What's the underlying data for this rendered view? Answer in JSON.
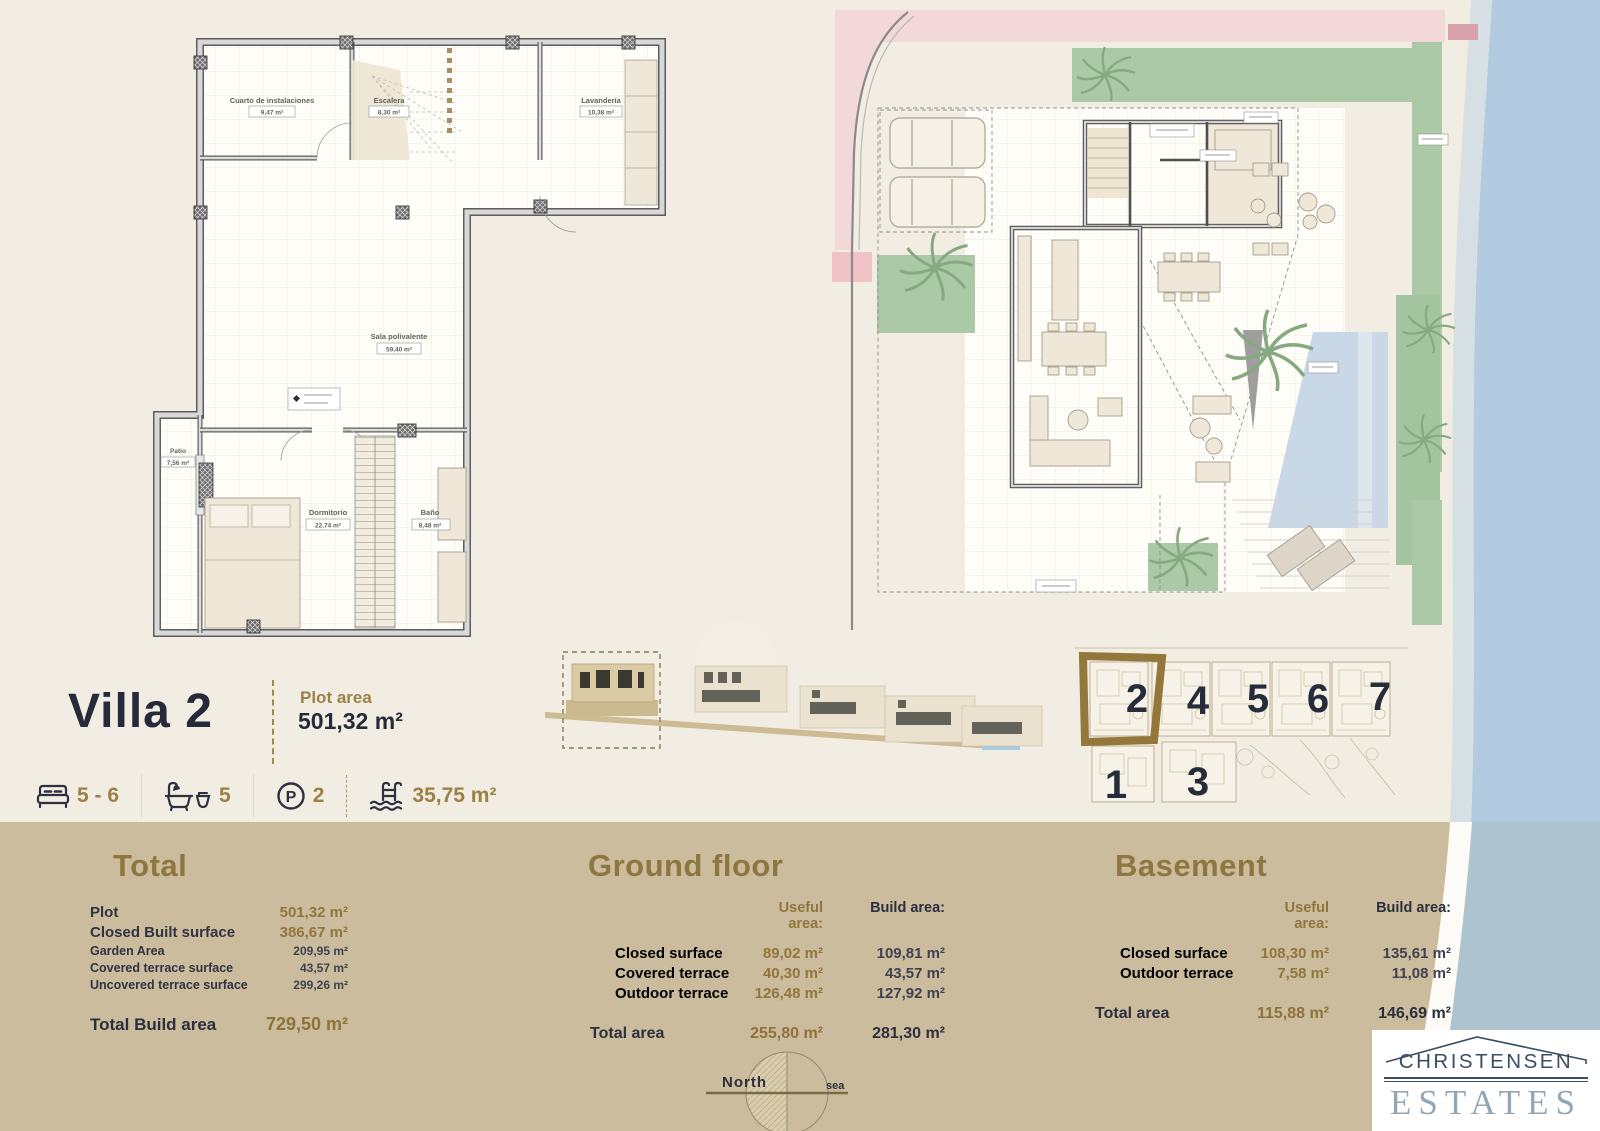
{
  "villa": {
    "title": "Villa 2",
    "plot_area_label": "Plot area",
    "plot_area_value": "501,32 m²",
    "features": {
      "bedrooms": "5 - 6",
      "bathrooms": "5",
      "parking": "2",
      "pool": "35,75 m²"
    }
  },
  "basement_plan": {
    "rooms": [
      {
        "name": "Cuarto de instalaciones",
        "area": "9,47 m²"
      },
      {
        "name": "Escalera",
        "area": "8,30 m²"
      },
      {
        "name": "Lavandería",
        "area": "10,38 m²"
      },
      {
        "name": "Sala polivalente",
        "area": "59,40 m²"
      },
      {
        "name": "Patio",
        "area": "7,56 m²"
      },
      {
        "name": "Dormitorio",
        "area": "22,74 m²"
      },
      {
        "name": "Baño",
        "area": "8,48 m²"
      }
    ]
  },
  "site_plan": {
    "villas": [
      "1",
      "2",
      "3",
      "4",
      "5",
      "6",
      "7"
    ],
    "highlighted": "2"
  },
  "compass": {
    "north_label": "North",
    "sea_label": "sea"
  },
  "tables": {
    "total": {
      "heading": "Total",
      "rows": [
        {
          "label": "Plot",
          "value": "501,32 m²"
        },
        {
          "label": "Closed Built surface",
          "value": "386,67 m²"
        },
        {
          "label": "Garden Area",
          "value": "209,95 m²"
        },
        {
          "label": "Covered terrace surface",
          "value": "43,57 m²"
        },
        {
          "label": "Uncovered terrace surface",
          "value": "299,26 m²"
        }
      ],
      "total_label": "Total Build area",
      "total_value": "729,50 m²"
    },
    "ground_floor": {
      "heading": "Ground floor",
      "col_useful": "Useful area:",
      "col_build": "Build area:",
      "rows": [
        {
          "label": "Closed surface",
          "useful": "89,02 m²",
          "build": "109,81 m²"
        },
        {
          "label": "Covered terrace",
          "useful": "40,30 m²",
          "build": "43,57 m²"
        },
        {
          "label": "Outdoor terrace",
          "useful": "126,48 m²",
          "build": "127,92 m²"
        }
      ],
      "total_label": "Total area",
      "total_useful": "255,80 m²",
      "total_build": "281,30 m²"
    },
    "basement": {
      "heading": "Basement",
      "col_useful": "Useful area:",
      "col_build": "Build area:",
      "rows": [
        {
          "label": "Closed surface",
          "useful": "108,30 m²",
          "build": "135,61 m²"
        },
        {
          "label": "Outdoor terrace",
          "useful": "7,58 m²",
          "build": "11,08 m²"
        }
      ],
      "total_label": "Total area",
      "total_useful": "115,88 m²",
      "total_build": "146,69 m²"
    }
  },
  "logo": {
    "line1": "CHRISTENSEN",
    "line2": "ESTATES"
  },
  "colors": {
    "accent_gold": "#9b8145",
    "text_navy": "#262b3b",
    "band_tan": "#cbbc9e",
    "garden_green": "#abc9a6",
    "pool_blue": "#c8d8e7",
    "sea_blue": "#b2cbe0",
    "road_pink": "#f3d8da",
    "logo_navy": "#3a4f63",
    "logo_gray_blue": "#92a6b6"
  }
}
